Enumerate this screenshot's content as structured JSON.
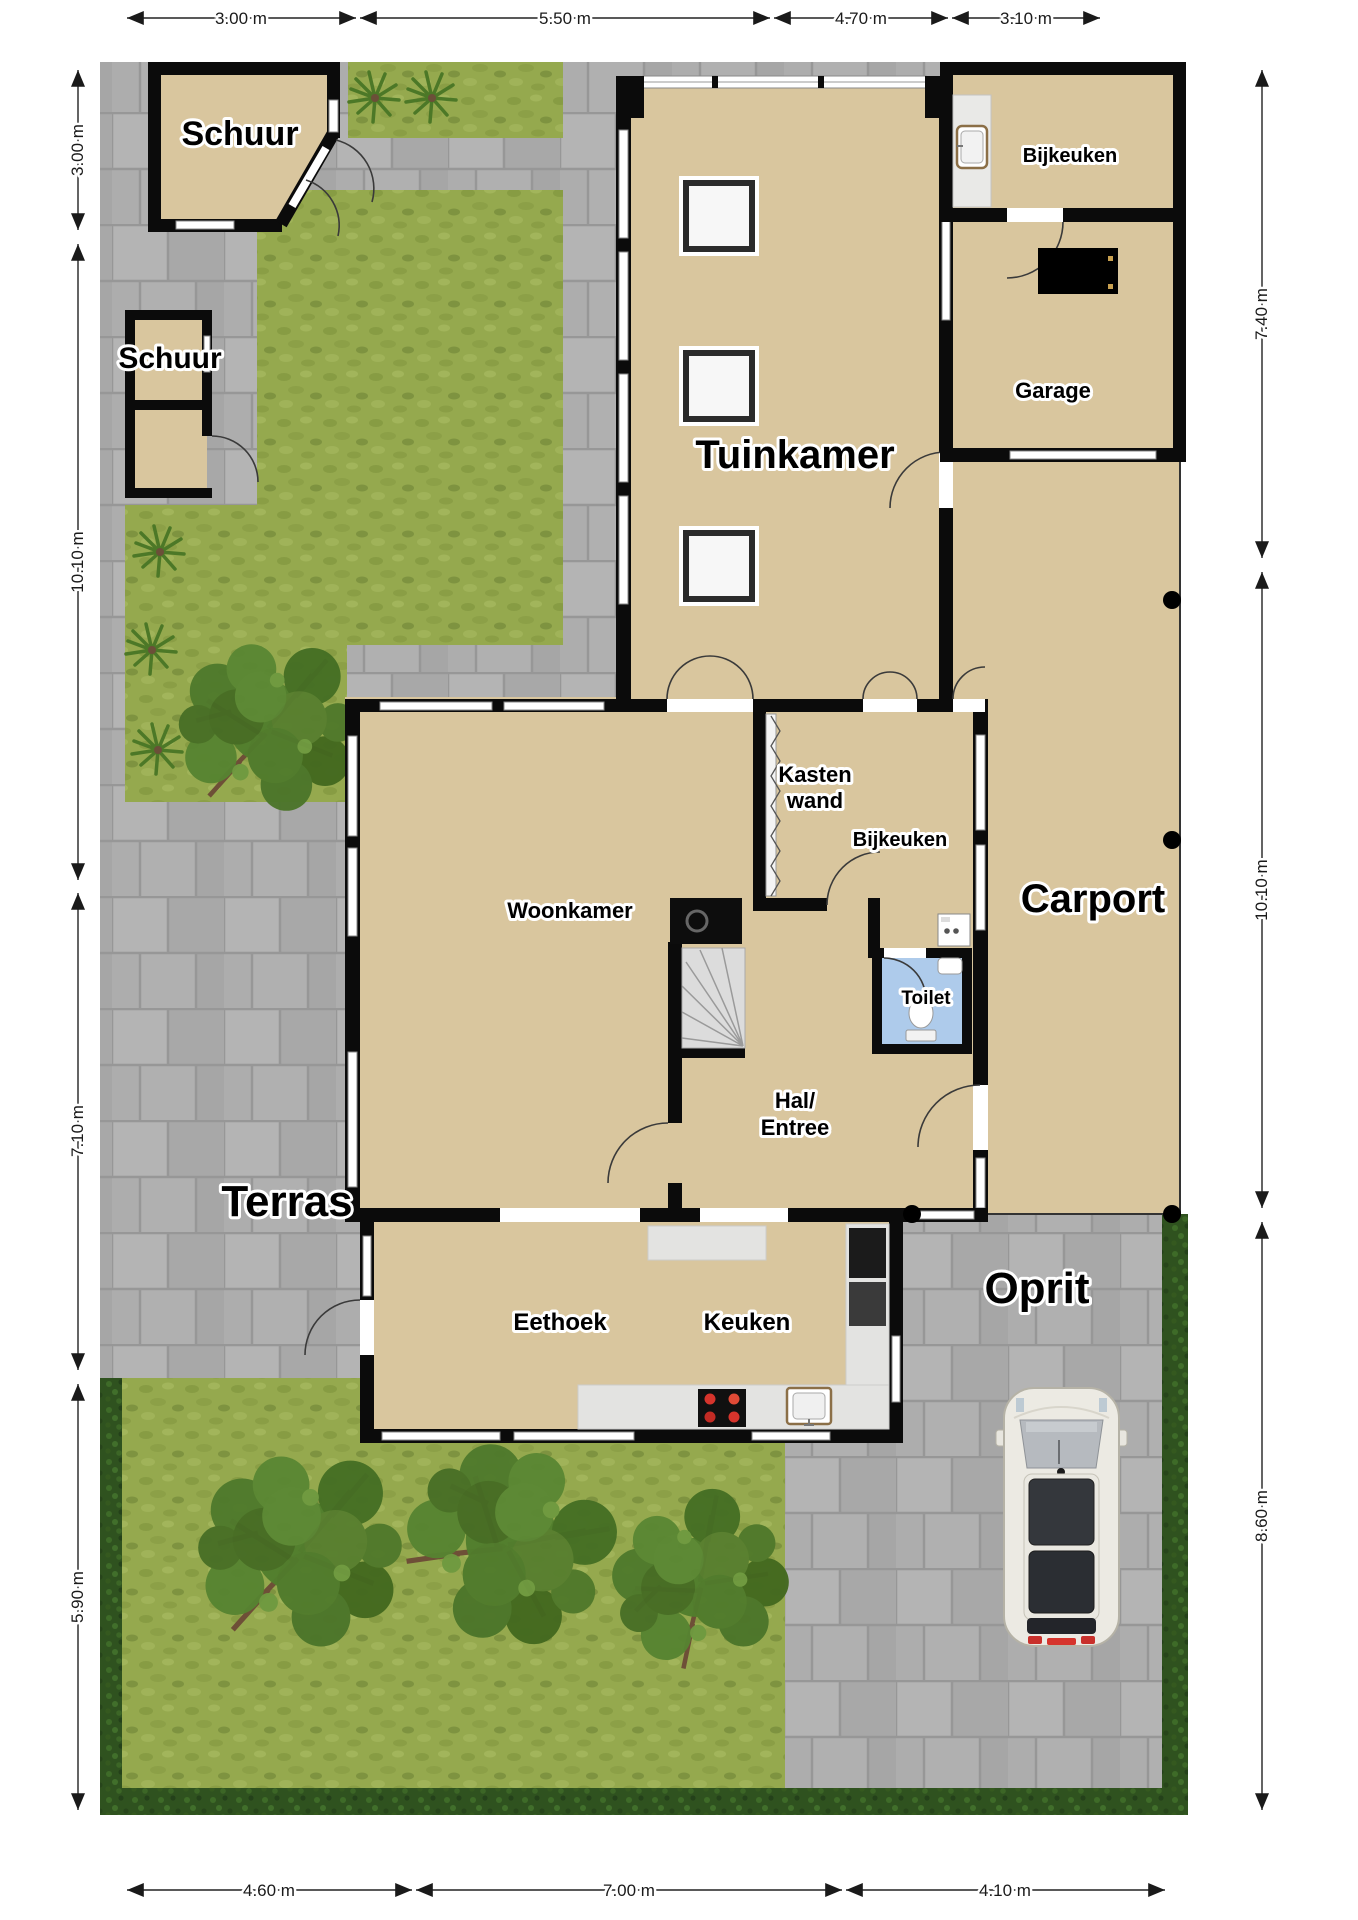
{
  "meta": {
    "type": "floor-plan-with-garden",
    "units": "m"
  },
  "dimensions": {
    "top": [
      {
        "label": "3.00 m"
      },
      {
        "label": "5.50 m"
      },
      {
        "label": "4.70 m"
      },
      {
        "label": "3.10 m"
      }
    ],
    "left": [
      {
        "label": "3.00 m"
      },
      {
        "label": "10.10 m"
      },
      {
        "label": "7.10 m"
      },
      {
        "label": "5.90 m"
      }
    ],
    "right": [
      {
        "label": "7.40 m"
      },
      {
        "label": "10.10 m"
      },
      {
        "label": "8.60 m"
      }
    ],
    "bottom": [
      {
        "label": "4.60 m"
      },
      {
        "label": "7.00 m"
      },
      {
        "label": "4.10 m"
      }
    ]
  },
  "rooms": {
    "schuur_top": "Schuur",
    "schuur_small": "Schuur",
    "tuinkamer": "Tuinkamer",
    "bijkeuken_top": "Bijkeuken",
    "garage": "Garage",
    "kastenwand_line1": "Kasten",
    "kastenwand_line2": "wand",
    "bijkeuken": "Bijkeuken",
    "carport": "Carport",
    "woonkamer": "Woonkamer",
    "toilet": "Toilet",
    "hal_line1": "Hal/",
    "hal_line2": "Entree",
    "terras": "Terras",
    "eethoek": "Eethoek",
    "keuken": "Keuken",
    "oprit": "Oprit"
  },
  "colors": {
    "floor": "#D9C69E",
    "wall": "#0B0B0B",
    "pavement": "#ACACAC",
    "grass": "#95A94E",
    "hedge": "#2F521F",
    "toilet_floor": "#AECBEB",
    "stairs": "#DCDCDC",
    "counter": "#E5E5E3",
    "burner": "#D6342C",
    "sink_frame": "#8B6F47",
    "car_body": "#ECEAE3",
    "dimension_text": "#1A1A1A"
  }
}
